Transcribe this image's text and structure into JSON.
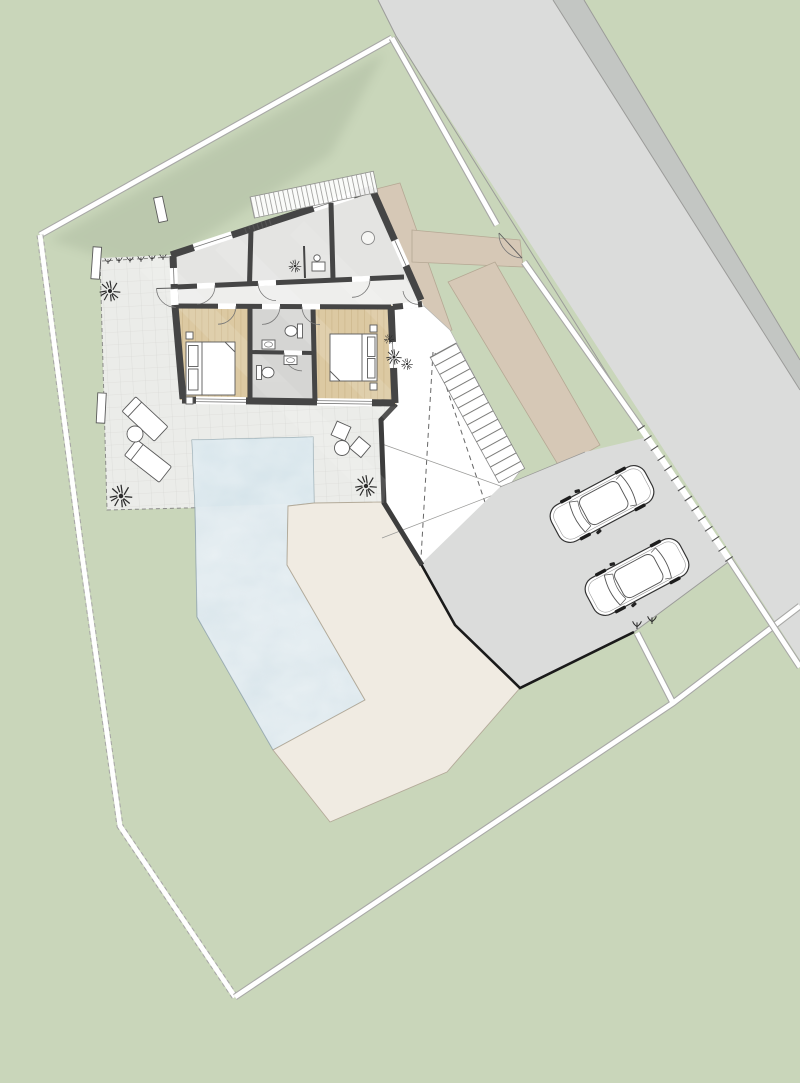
{
  "meta": {
    "title": "Residential site plan - top view",
    "image_type": "architectural site plan rendering",
    "canvas": {
      "width": 800,
      "height": 1083
    }
  },
  "palette": {
    "lawn": "#c9d6ba",
    "lawn_shadow": "#5a6a52",
    "road": "#dbdcdb",
    "road_shoulder": "#c3c6c3",
    "road_edge": "#9b9b99",
    "boundary_casing": "#a8a8a6",
    "boundary_white": "#ffffff",
    "path": "#d6c8b6",
    "path_edge": "#b5a894",
    "driveway_edge": "#1a1a1a",
    "terrace": "#ebece9",
    "terrace_line": "#d5d5d2",
    "patio": "#f0ebe2",
    "patio_edge": "#b3aa99",
    "pool_water": "#d7e4ea",
    "pool_water_deep": "#cfdfe7",
    "pool_edge": "#8fa3ab",
    "wall": "#454545",
    "retaining_wall": "#3d3d3d",
    "room_gray": "#e4e4e2",
    "corridor": "#eeeeec",
    "bathroom": "#d5d5d3",
    "wood": "#dcc9a2",
    "wood_line": "#c3ab7e",
    "furniture_line": "#5a5a5a",
    "stair_line": "#7a7a78",
    "pergola_line": "#9a9a98",
    "car_body": "#ffffff",
    "car_line": "#333333",
    "plant": "#2c2c2c"
  },
  "site": {
    "ground": "lawn",
    "street": {
      "orientation": "diagonal NE",
      "shoulder_strip": true
    },
    "property_boundary": {
      "style": "white double line",
      "segments": [
        "northwest",
        "west",
        "southeast-diagonal",
        "roadside",
        "parcel-spur"
      ],
      "street_gate": "swing gate with quarter-circle arc",
      "driveway_gate": "hatched sliding gate line"
    },
    "footpath": {
      "arms": [
        "along-house-entrance",
        "to-street-gate",
        "to-driveway"
      ]
    },
    "driveway": {
      "surface": "same as street",
      "cars_parked": 2
    },
    "exterior_stairs": {
      "steps": 14
    },
    "carport_area": {
      "roof_outline": "dashed",
      "diagonal_marks": "X"
    },
    "terrace": {
      "furniture": [
        "sun-lounger",
        "sun-lounger",
        "round-table",
        "lounge-chair",
        "lounge-chair",
        "round-table"
      ]
    },
    "pool": {
      "shape": "bent L band",
      "texture": "water ripples"
    },
    "patio": {
      "surface": "cream"
    },
    "plants_count": 9,
    "garden_posts": 3
  },
  "house": {
    "wings": [
      "angled north wing",
      "orthogonal south wing"
    ],
    "rooms": [
      {
        "name": "room-northwest",
        "floor": "gray"
      },
      {
        "name": "room-middle",
        "floor": "gray",
        "items": [
          "potted-plant",
          "side-table"
        ]
      },
      {
        "name": "entrance-hall",
        "floor": "gray",
        "items": [
          "round-lamp"
        ]
      },
      {
        "name": "corridor",
        "floor": "light-gray"
      },
      {
        "name": "bedroom-west",
        "floor": "wood",
        "items": [
          "double-bed",
          "nightstand",
          "nightstand"
        ]
      },
      {
        "name": "bathroom-upper",
        "floor": "gray",
        "items": [
          "toilet",
          "washbasin"
        ]
      },
      {
        "name": "bathroom-lower",
        "floor": "gray",
        "items": [
          "toilet",
          "washbasin"
        ]
      },
      {
        "name": "bedroom-east",
        "floor": "wood",
        "items": [
          "double-bed",
          "nightstand",
          "nightstand"
        ]
      }
    ],
    "pergola": {
      "style": "slatted canopy band over north facade"
    },
    "door_arcs": 10,
    "window_openings": 6
  },
  "vehicles": [
    {
      "type": "car",
      "color": "white",
      "heading": "southwest"
    },
    {
      "type": "car",
      "color": "white",
      "heading": "southwest"
    }
  ]
}
